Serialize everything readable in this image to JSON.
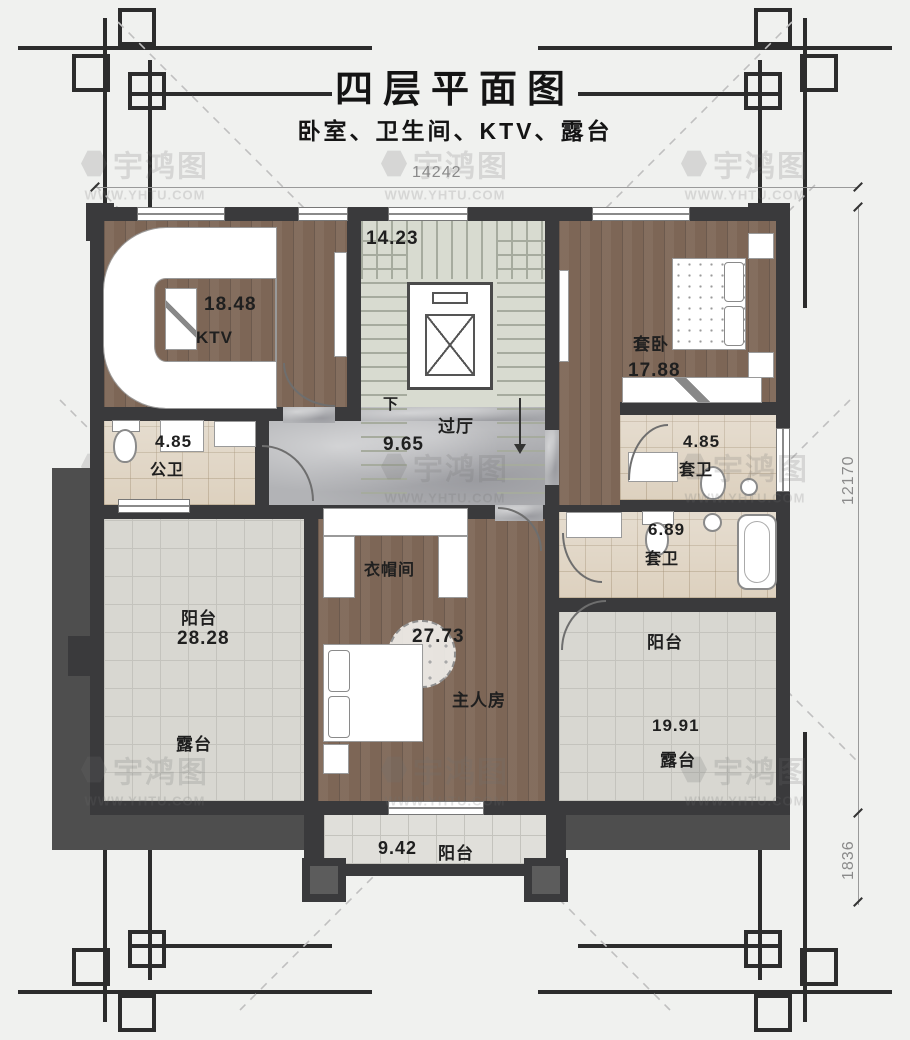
{
  "title": "四层平面图",
  "subtitle": "卧室、卫生间、KTV、露台",
  "watermark": {
    "logo": "宇鸿图",
    "url": "WWW.YHTU.COM"
  },
  "dimensions": {
    "top": "14242",
    "right": "12170",
    "bottom_right": "1836"
  },
  "rooms": {
    "stairwell": {
      "area": "14.23",
      "direction": "下"
    },
    "ktv": {
      "label": "KTV",
      "area": "18.48"
    },
    "suite_bedroom": {
      "label": "套卧",
      "area": "17.88"
    },
    "public_bath": {
      "label": "公卫",
      "area": "4.85"
    },
    "hallway": {
      "label": "过厅",
      "area": "9.65"
    },
    "suite_bath_upper": {
      "label": "套卫",
      "area": "4.85"
    },
    "suite_bath_lower": {
      "label": "套卫",
      "area": "6.89"
    },
    "cloakroom": {
      "label": "衣帽间"
    },
    "master_bedroom": {
      "label": "主人房",
      "area": "27.73"
    },
    "terrace_left": {
      "label": "阳台",
      "area": "28.28",
      "sub_label": "露台"
    },
    "terrace_right": {
      "label": "阳台",
      "area": "19.91",
      "sub_label": "露台"
    },
    "balcony_bottom": {
      "label": "阳台",
      "area": "9.42"
    }
  },
  "colors": {
    "wall": "#3a3a3c",
    "wood": "#7d6656",
    "tile": "#ddd1bf",
    "terrace": "#d8d7d1",
    "marble": "#b2b3b6",
    "stair": "#d8dbd0"
  }
}
